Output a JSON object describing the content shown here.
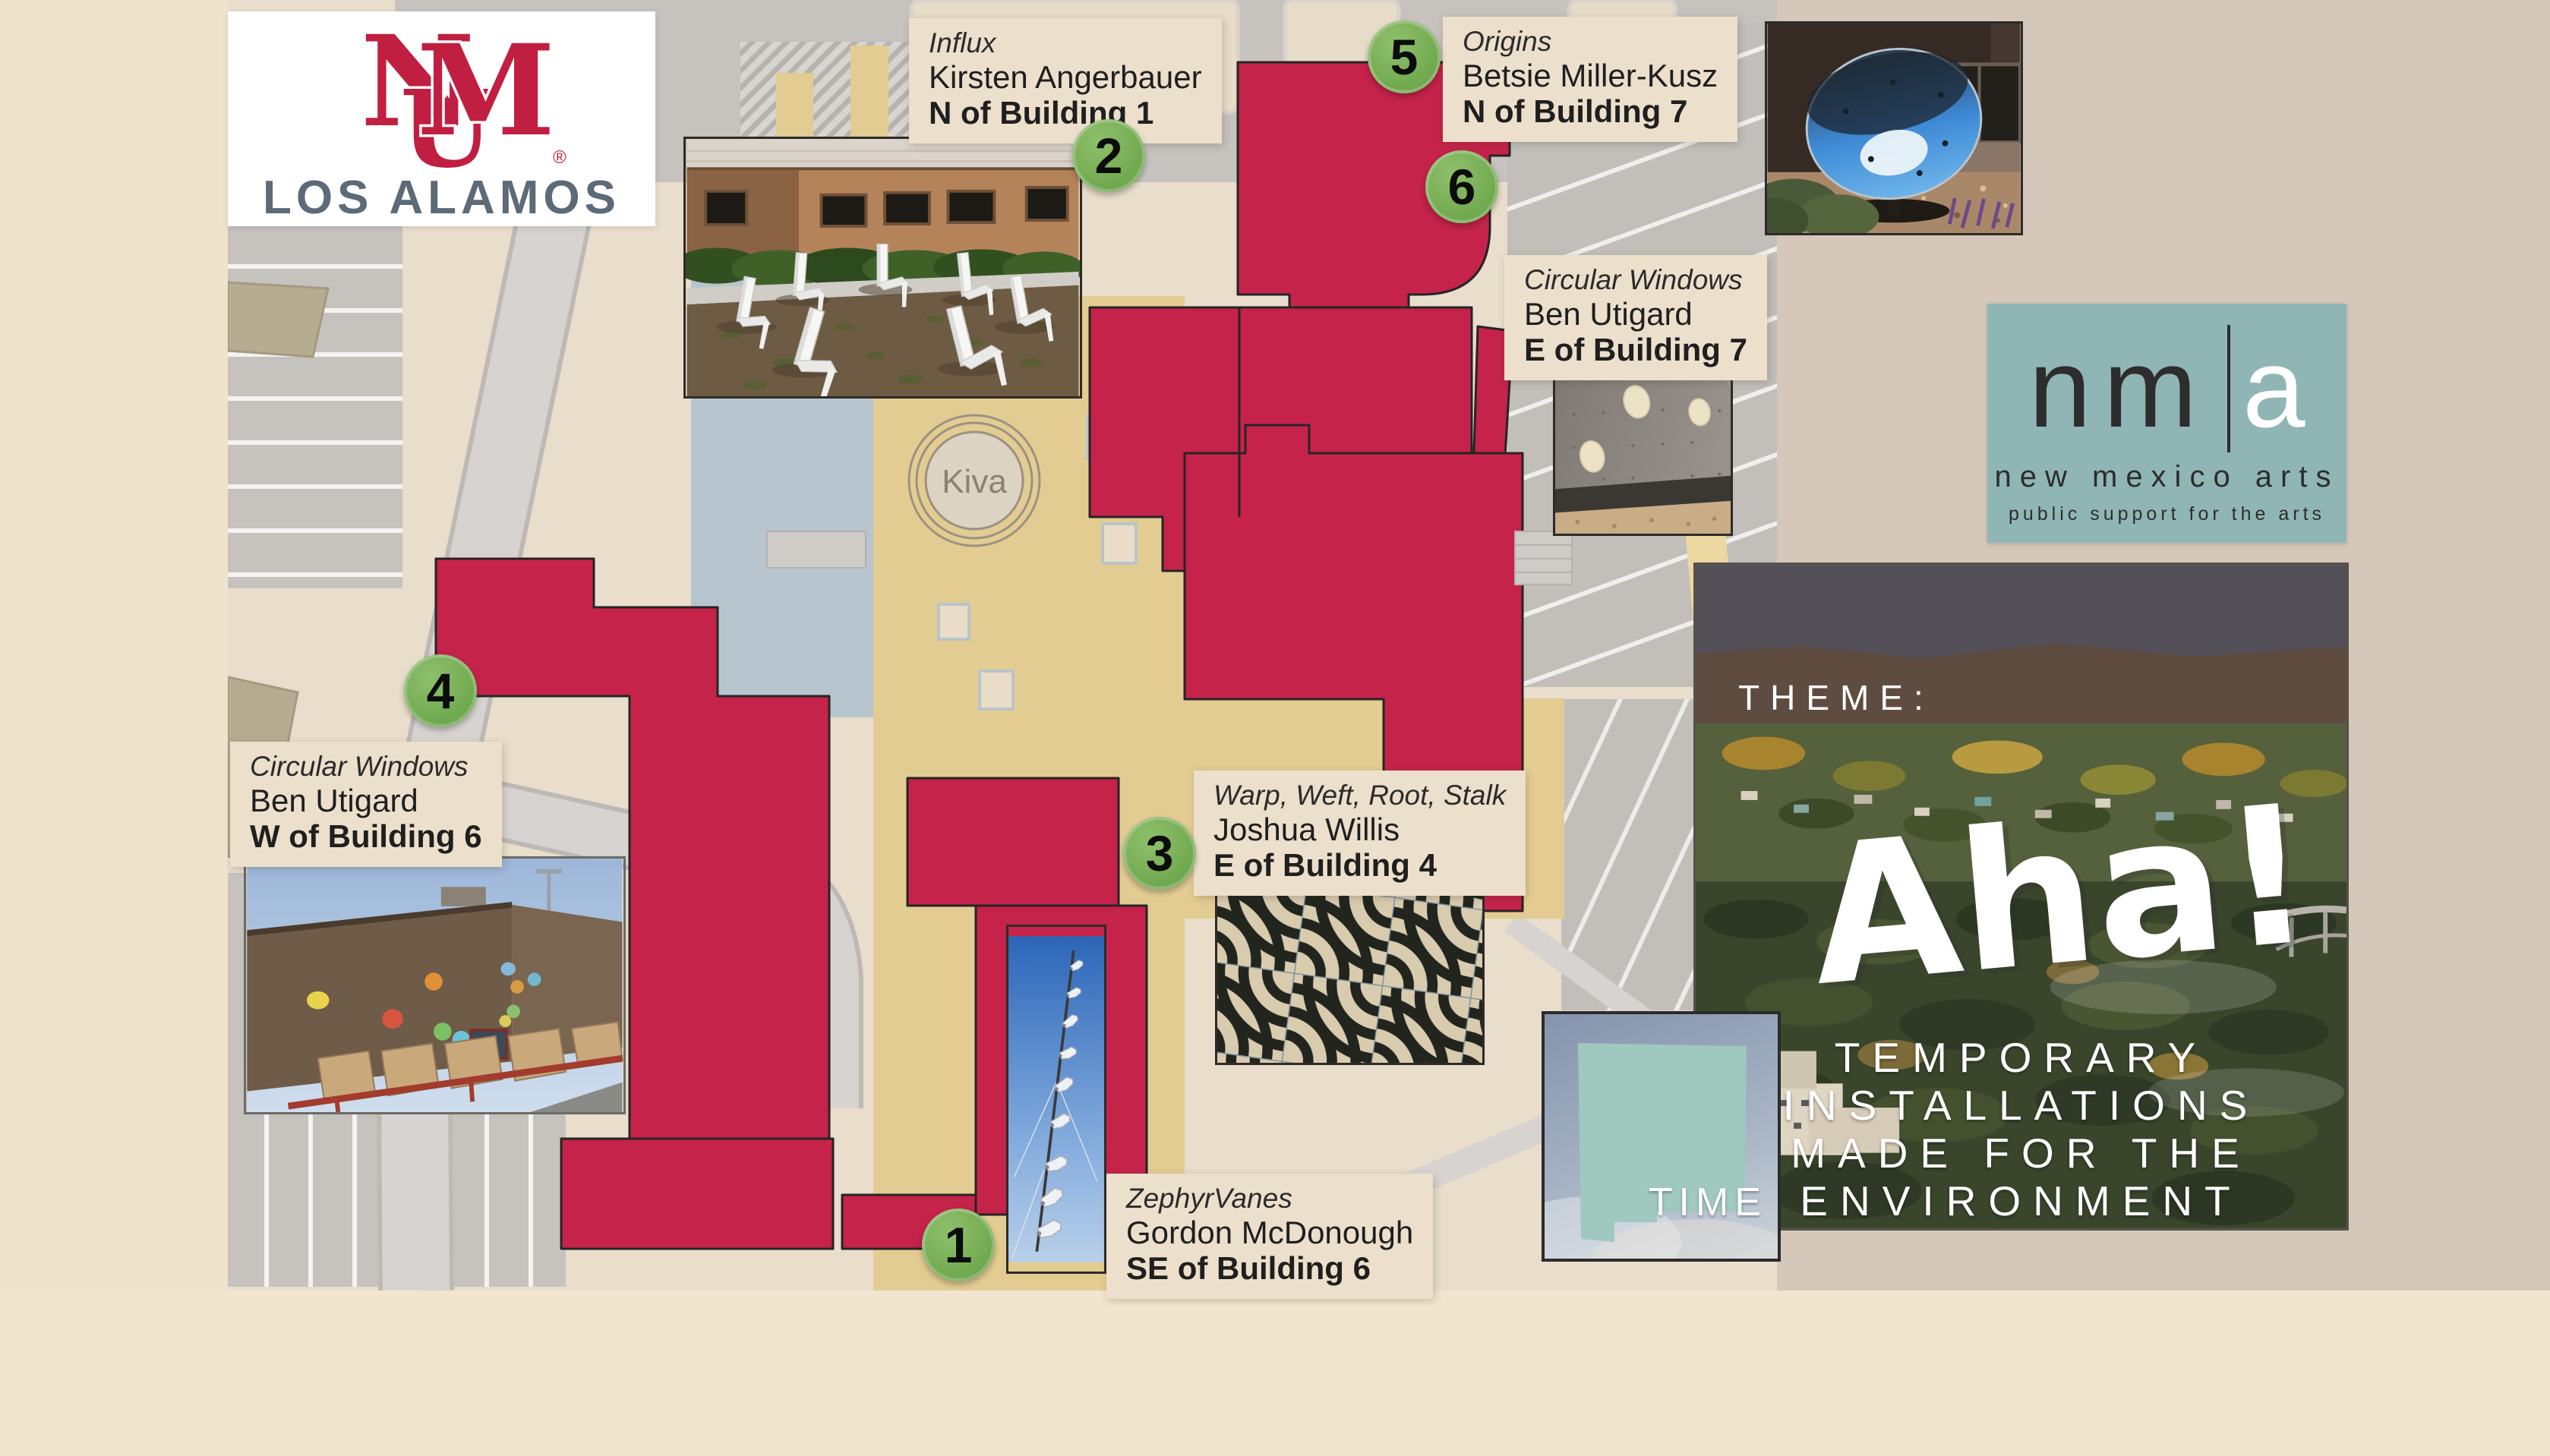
{
  "colors": {
    "building_red": "#c5234a",
    "marker_green": "#6fa84e",
    "label_bg": "#ece0cc",
    "plaza_tan": "#e3cc92",
    "nma_teal": "#8fb6b4",
    "unm_crimson": "#c01f41",
    "campus_text": "#5d6a77"
  },
  "unm_logo": {
    "monogram_n": "N",
    "monogram_m": "M",
    "monogram_u": "U",
    "registered": "®",
    "campus": "LOS ALAMOS"
  },
  "nma_logo": {
    "letters": "nm",
    "letter_a": "a",
    "name": "new mexico arts",
    "tagline": "public support for the arts"
  },
  "map": {
    "kiva": "Kiva"
  },
  "markers": [
    {
      "num": "1"
    },
    {
      "num": "2"
    },
    {
      "num": "3"
    },
    {
      "num": "4"
    },
    {
      "num": "5"
    },
    {
      "num": "6"
    }
  ],
  "labels": [
    {
      "id": "zephyrvanes",
      "title": "ZephyrVanes",
      "artist": "Gordon McDonough",
      "location": "SE of Building 6"
    },
    {
      "id": "influx",
      "title": "Influx",
      "artist": "Kirsten Angerbauer",
      "location": "N of Building 1"
    },
    {
      "id": "warp-weft-root-stalk",
      "title": "Warp, Weft, Root, Stalk",
      "artist": "Joshua Willis",
      "location": "E of Building 4"
    },
    {
      "id": "circular-windows-w",
      "title": "Circular Windows",
      "artist": "Ben Utigard",
      "location": "W of Building 6"
    },
    {
      "id": "origins",
      "title": "Origins",
      "artist": "Betsie Miller-Kusz",
      "location": "N of Building 7"
    },
    {
      "id": "circular-windows-e",
      "title": "Circular Windows",
      "artist": "Ben Utigard",
      "location": "E of Building 7"
    }
  ],
  "theme_panel": {
    "label": "THEME:",
    "word": "Aha!",
    "lines": [
      "TEMPORARY",
      "INSTALLATIONS",
      "MADE FOR THE",
      "ENVIRONMENT"
    ]
  },
  "time_panel": {
    "word": "TIME"
  }
}
